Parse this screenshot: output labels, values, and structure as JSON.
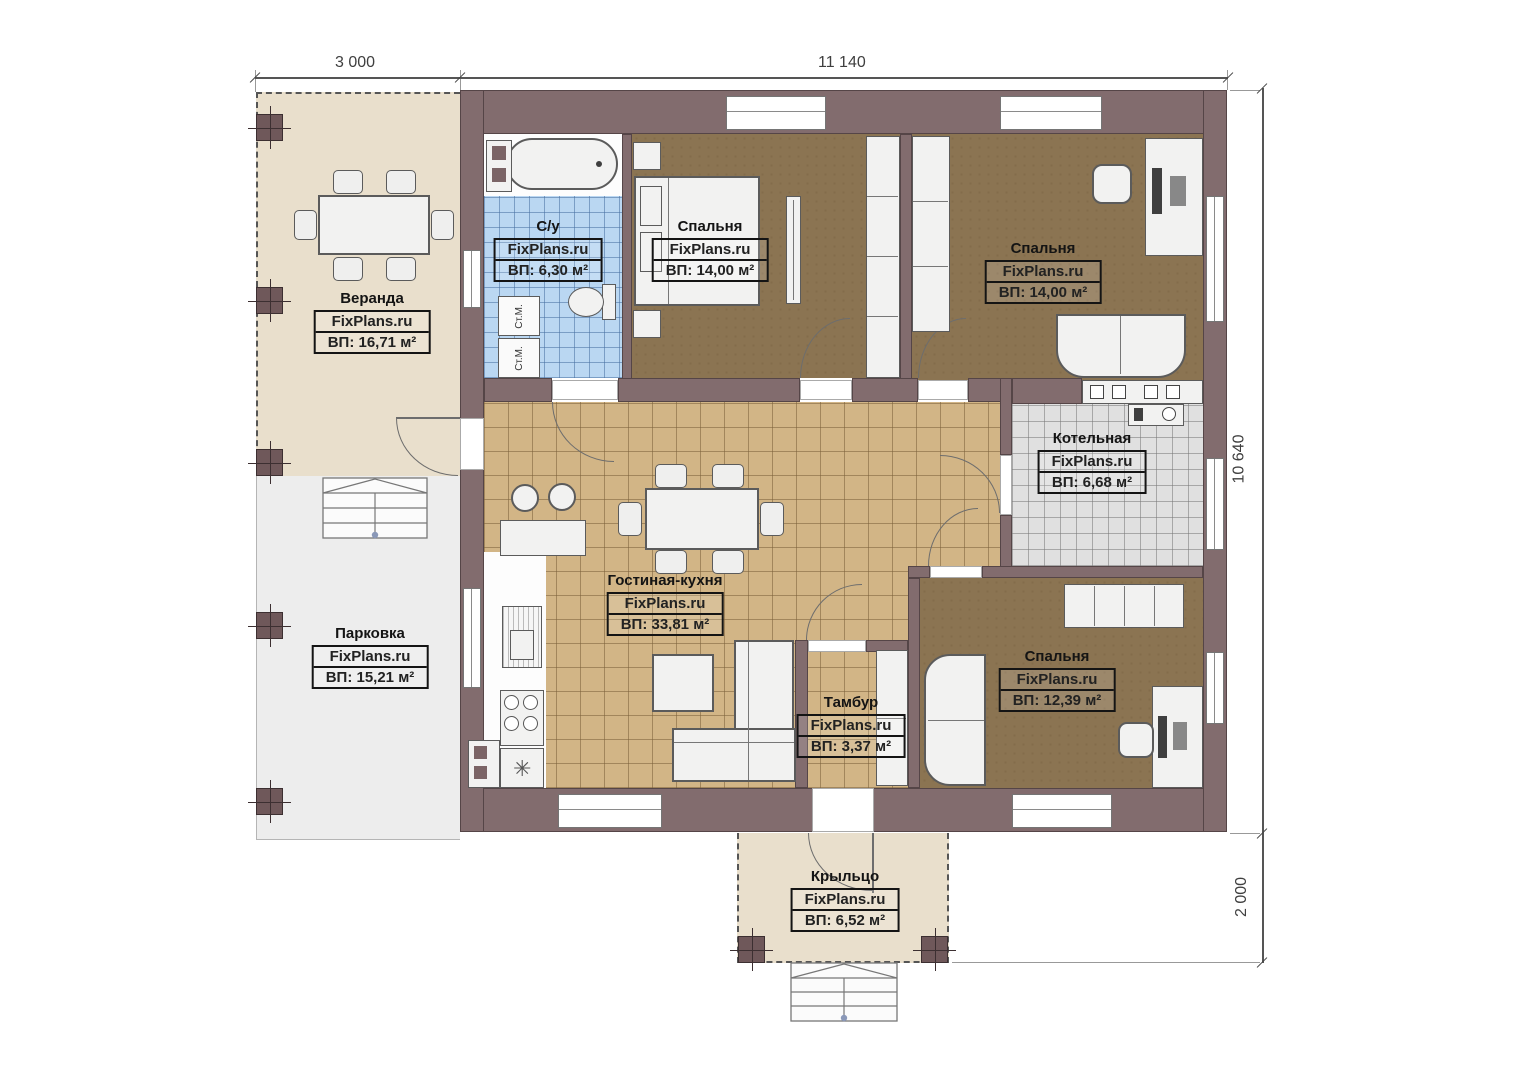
{
  "plan_title": "floor-plan",
  "dimensions": {
    "top_left": "3 000",
    "top_right": "11 140",
    "right_top": "10 640",
    "right_bottom": "2 000"
  },
  "rooms": {
    "veranda": {
      "name": "Веранда",
      "watermark": "FixPlans.ru",
      "area": "ВП: 16,71 м²"
    },
    "parking": {
      "name": "Парковка",
      "watermark": "FixPlans.ru",
      "area": "ВП: 15,21 м²"
    },
    "bathroom": {
      "name": "С/у",
      "watermark": "FixPlans.ru",
      "area": "ВП: 6,30 м²"
    },
    "bedroom1": {
      "name": "Спальня",
      "watermark": "FixPlans.ru",
      "area": "ВП: 14,00 м²"
    },
    "bedroom2": {
      "name": "Спальня",
      "watermark": "FixPlans.ru",
      "area": "ВП: 14,00 м²"
    },
    "boiler": {
      "name": "Котельная",
      "watermark": "FixPlans.ru",
      "area": "ВП: 6,68 м²"
    },
    "living": {
      "name": "Гостиная-кухня",
      "watermark": "FixPlans.ru",
      "area": "ВП: 33,81 м²"
    },
    "tambur": {
      "name": "Тамбур",
      "watermark": "FixPlans.ru",
      "area": "ВП: 3,37 м²"
    },
    "bedroom3": {
      "name": "Спальня",
      "watermark": "FixPlans.ru",
      "area": "ВП: 12,39 м²"
    },
    "porch": {
      "name": "Крыльцо",
      "watermark": "FixPlans.ru",
      "area": "ВП: 6,52 м²"
    }
  },
  "appliances": {
    "washer1": "Ст.М.",
    "washer2": "Ст.М."
  },
  "icons": {
    "sink": "✳"
  },
  "colors": {
    "wall": "#826c6e",
    "bedroom_floor": "#8b7452",
    "living_floor": "#d2b586",
    "bathroom_floor": "#bad7f2",
    "boiler_floor": "#e0e0e0",
    "veranda_floor": "#e9dfcc",
    "parking_floor": "#ededed"
  }
}
